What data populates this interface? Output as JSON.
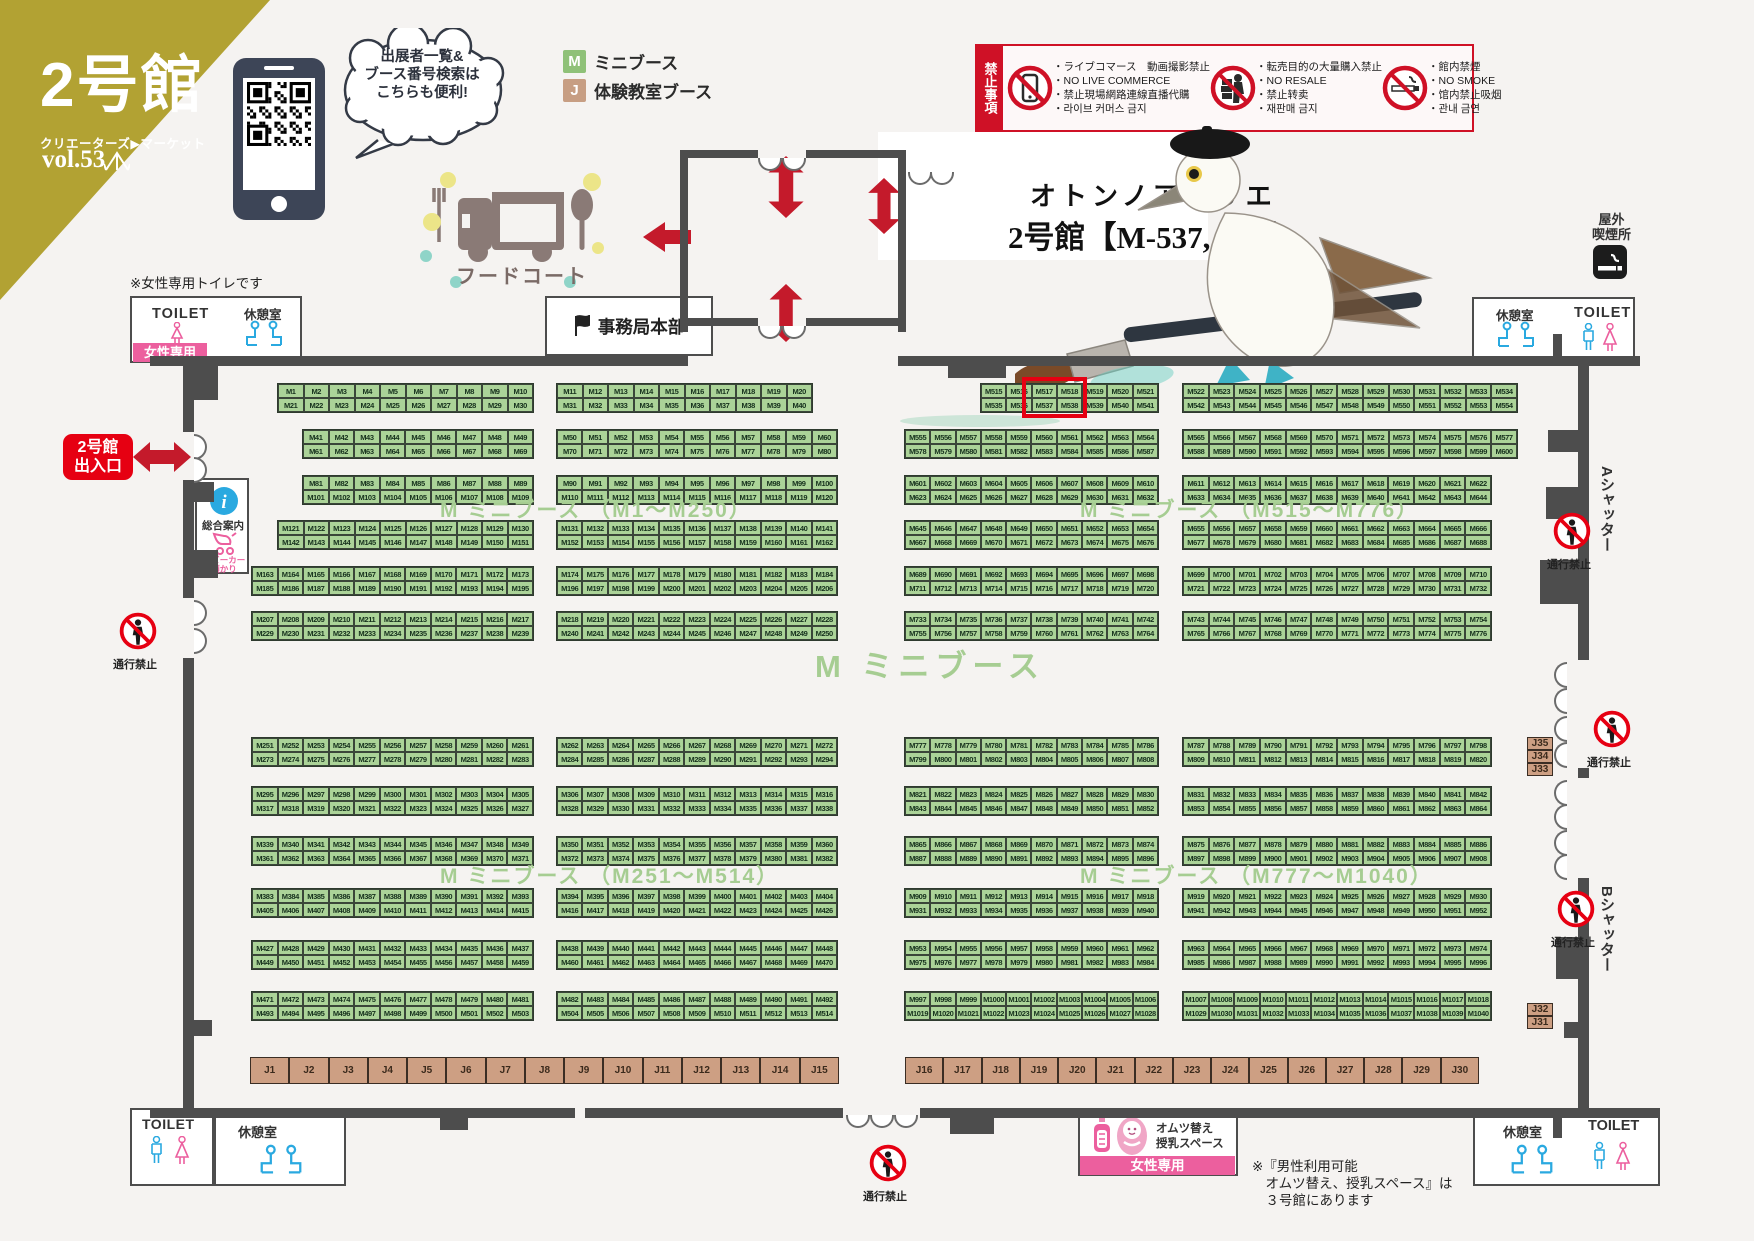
{
  "header": {
    "hall": "2号館",
    "brand": "クリエーターズ▶マーケット",
    "vol": "vol.53",
    "bubble": [
      "出展者一覧&",
      "ブース番号検索は",
      "こちらも便利!"
    ]
  },
  "legend": {
    "m": {
      "code": "M",
      "label": "ミニブース",
      "color": "#8fc178"
    },
    "j": {
      "code": "J",
      "label": "体験教室ブース",
      "color": "#c79e83"
    }
  },
  "prohibited": {
    "title": "禁止事項",
    "groups": [
      {
        "icon": "no-live-commerce-icon",
        "lines": [
          "・ライブコマース　動画撮影禁止",
          "・NO LIVE COMMERCE",
          "・禁止現場網路連線直播代購",
          "・라이브 커머스 금지"
        ]
      },
      {
        "icon": "no-resale-icon",
        "lines": [
          "・転売目的の大量購入禁止",
          "・NO RESALE",
          "・禁止转卖",
          "・재판매 금지"
        ]
      },
      {
        "icon": "no-smoking-icon",
        "lines": [
          "・館内禁煙",
          "・NO SMOKE",
          "・馆内禁止吸烟",
          "・관내 금연"
        ]
      }
    ]
  },
  "highlight": {
    "line1": "オトンノアトリエ",
    "line2": "2号館【M-537, 538】"
  },
  "facilities": {
    "food_court": "フードコート",
    "office": "事務局本部",
    "outdoor_smoking": [
      "屋外",
      "喫煙所"
    ],
    "toilet": "TOILET",
    "rest_room": "休憩室",
    "women_only": "女性専用",
    "women_toilet_note": "※女性専用トイレです",
    "entrance": [
      "2号館",
      "出入口"
    ],
    "info": "総合案内",
    "stroller": [
      "ベビーカー",
      "預かり"
    ],
    "no_entry": "通行禁止",
    "shutter_a": "Aシャッター",
    "shutter_b": "Bシャッター",
    "diaper": [
      "オムツ替え",
      "授乳スペース"
    ],
    "diaper_note": [
      "※『男性利用可能",
      "　オムツ替え、授乳スペース』は",
      "　３号館にあります"
    ]
  },
  "section_labels": [
    {
      "text": "M ミニブース （M1〜M250）",
      "x": 440,
      "y": 494,
      "size": 21
    },
    {
      "text": "M ミニブース （M515〜M776）",
      "x": 1080,
      "y": 494,
      "size": 21
    },
    {
      "text": "M ミニブース",
      "x": 815,
      "y": 641,
      "size": 31
    },
    {
      "text": "M ミニブース （M251〜M514）",
      "x": 440,
      "y": 860,
      "size": 21
    },
    {
      "text": "M ミニブース （M777〜M1040）",
      "x": 1080,
      "y": 860,
      "size": 21
    }
  ],
  "map": {
    "booth_prefix": "M",
    "bands": [
      {
        "y": 384,
        "strips": [
          {
            "x": 278,
            "w": 255,
            "c": 10,
            "t": 1,
            "b": 21
          },
          {
            "x": 557,
            "w": 255,
            "c": 10,
            "t": 11,
            "b": 31
          },
          {
            "x": 981,
            "w": 177,
            "c": 7,
            "t": 515,
            "b": 535
          },
          {
            "x": 1183,
            "w": 334,
            "c": 13,
            "t": 522,
            "b": 542
          }
        ]
      },
      {
        "y": 430,
        "strips": [
          {
            "x": 303,
            "w": 230,
            "c": 9,
            "t": 41,
            "b": 61
          },
          {
            "x": 557,
            "w": 280,
            "c": 11,
            "t": 50,
            "b": 70
          },
          {
            "x": 905,
            "w": 253,
            "c": 10,
            "t": 555,
            "b": 578
          },
          {
            "x": 1183,
            "w": 334,
            "c": 13,
            "t": 565,
            "b": 588
          }
        ]
      },
      {
        "y": 476,
        "strips": [
          {
            "x": 303,
            "w": 230,
            "c": 9,
            "t": 81,
            "b": 101
          },
          {
            "x": 557,
            "w": 280,
            "c": 11,
            "t": 90,
            "b": 110
          },
          {
            "x": 905,
            "w": 253,
            "c": 10,
            "t": 601,
            "b": 623
          },
          {
            "x": 1183,
            "w": 308,
            "c": 12,
            "t": 611,
            "b": 633
          }
        ]
      },
      {
        "y": 521,
        "strips": [
          {
            "x": 278,
            "w": 255,
            "c": 10,
            "t": 121,
            "b": 142
          },
          {
            "x": 557,
            "w": 280,
            "c": 11,
            "t": 131,
            "b": 152
          },
          {
            "x": 905,
            "w": 253,
            "c": 10,
            "t": 645,
            "b": 667
          },
          {
            "x": 1183,
            "w": 308,
            "c": 12,
            "t": 655,
            "b": 677
          }
        ]
      },
      {
        "y": 567,
        "strips": [
          {
            "x": 252,
            "w": 281,
            "c": 11,
            "t": 163,
            "b": 185
          },
          {
            "x": 557,
            "w": 280,
            "c": 11,
            "t": 174,
            "b": 196
          },
          {
            "x": 905,
            "w": 253,
            "c": 10,
            "t": 689,
            "b": 711
          },
          {
            "x": 1183,
            "w": 308,
            "c": 12,
            "t": 699,
            "b": 721
          }
        ]
      },
      {
        "y": 612,
        "strips": [
          {
            "x": 252,
            "w": 281,
            "c": 11,
            "t": 207,
            "b": 229
          },
          {
            "x": 557,
            "w": 280,
            "c": 11,
            "t": 218,
            "b": 240
          },
          {
            "x": 905,
            "w": 253,
            "c": 10,
            "t": 733,
            "b": 755
          },
          {
            "x": 1183,
            "w": 308,
            "c": 12,
            "t": 743,
            "b": 765
          }
        ]
      },
      {
        "y": 738,
        "strips": [
          {
            "x": 252,
            "w": 281,
            "c": 11,
            "t": 251,
            "b": 273
          },
          {
            "x": 557,
            "w": 280,
            "c": 11,
            "t": 262,
            "b": 284
          },
          {
            "x": 905,
            "w": 253,
            "c": 10,
            "t": 777,
            "b": 799
          },
          {
            "x": 1183,
            "w": 308,
            "c": 12,
            "t": 787,
            "b": 809
          }
        ]
      },
      {
        "y": 787,
        "strips": [
          {
            "x": 252,
            "w": 281,
            "c": 11,
            "t": 295,
            "b": 317
          },
          {
            "x": 557,
            "w": 280,
            "c": 11,
            "t": 306,
            "b": 328
          },
          {
            "x": 905,
            "w": 253,
            "c": 10,
            "t": 821,
            "b": 843
          },
          {
            "x": 1183,
            "w": 308,
            "c": 12,
            "t": 831,
            "b": 853
          }
        ]
      },
      {
        "y": 837,
        "strips": [
          {
            "x": 252,
            "w": 281,
            "c": 11,
            "t": 339,
            "b": 361
          },
          {
            "x": 557,
            "w": 280,
            "c": 11,
            "t": 350,
            "b": 372
          },
          {
            "x": 905,
            "w": 253,
            "c": 10,
            "t": 865,
            "b": 887
          },
          {
            "x": 1183,
            "w": 308,
            "c": 12,
            "t": 875,
            "b": 897
          }
        ]
      },
      {
        "y": 889,
        "strips": [
          {
            "x": 252,
            "w": 281,
            "c": 11,
            "t": 383,
            "b": 405
          },
          {
            "x": 557,
            "w": 280,
            "c": 11,
            "t": 394,
            "b": 416
          },
          {
            "x": 905,
            "w": 253,
            "c": 10,
            "t": 909,
            "b": 931
          },
          {
            "x": 1183,
            "w": 308,
            "c": 12,
            "t": 919,
            "b": 941
          }
        ]
      },
      {
        "y": 941,
        "strips": [
          {
            "x": 252,
            "w": 281,
            "c": 11,
            "t": 427,
            "b": 449
          },
          {
            "x": 557,
            "w": 280,
            "c": 11,
            "t": 438,
            "b": 460
          },
          {
            "x": 905,
            "w": 253,
            "c": 10,
            "t": 953,
            "b": 975
          },
          {
            "x": 1183,
            "w": 308,
            "c": 12,
            "t": 963,
            "b": 985
          }
        ]
      },
      {
        "y": 992,
        "strips": [
          {
            "x": 252,
            "w": 281,
            "c": 11,
            "t": 471,
            "b": 493
          },
          {
            "x": 557,
            "w": 280,
            "c": 11,
            "t": 482,
            "b": 504
          },
          {
            "x": 905,
            "w": 253,
            "c": 10,
            "t": 997,
            "b": 1019
          },
          {
            "x": 1183,
            "w": 308,
            "c": 12,
            "t": 1007,
            "b": 1029
          }
        ]
      }
    ],
    "j_rows": [
      {
        "x": 250,
        "y": 1057,
        "w": 589,
        "h": 27,
        "start": 1,
        "count": 15
      },
      {
        "x": 905,
        "y": 1057,
        "w": 574,
        "h": 27,
        "start": 16,
        "count": 15
      }
    ],
    "j_stacks": [
      {
        "x": 1527,
        "y": 737,
        "w": 26,
        "cell_h": 39,
        "labels": [
          "J35",
          "J34",
          "J33"
        ]
      },
      {
        "x": 1527,
        "y": 1003,
        "w": 26,
        "cell_h": 40,
        "labels": [
          "J32",
          "J31"
        ]
      }
    ],
    "highlight_box": {
      "x": 1022,
      "y": 377,
      "w": 65,
      "h": 41
    },
    "no_entry_positions": [
      {
        "x": 118,
        "y": 612
      },
      {
        "x": 1552,
        "y": 512
      },
      {
        "x": 1592,
        "y": 710
      },
      {
        "x": 1556,
        "y": 890
      },
      {
        "x": 868,
        "y": 1144
      }
    ],
    "walls": [
      [
        150,
        356,
        538,
        10
      ],
      [
        898,
        356,
        742,
        10
      ],
      [
        948,
        356,
        58,
        22
      ],
      [
        183,
        356,
        11,
        76
      ],
      [
        183,
        480,
        11,
        118
      ],
      [
        183,
        658,
        11,
        452
      ],
      [
        194,
        366,
        24,
        34
      ],
      [
        194,
        482,
        20,
        20
      ],
      [
        194,
        550,
        24,
        28
      ],
      [
        194,
        1020,
        18,
        16
      ],
      [
        1578,
        356,
        11,
        304
      ],
      [
        1578,
        768,
        11,
        10
      ],
      [
        1578,
        878,
        11,
        232
      ],
      [
        1548,
        430,
        30,
        22
      ],
      [
        1546,
        487,
        34,
        32
      ],
      [
        1540,
        560,
        40,
        44
      ],
      [
        1556,
        937,
        33,
        42
      ],
      [
        1564,
        1022,
        25,
        16
      ],
      [
        150,
        1108,
        425,
        10
      ],
      [
        585,
        1108,
        258,
        10
      ],
      [
        920,
        1108,
        740,
        10
      ],
      [
        950,
        1108,
        44,
        26
      ],
      [
        440,
        1108,
        28,
        22
      ],
      [
        680,
        150,
        8,
        182
      ],
      [
        898,
        150,
        8,
        182
      ],
      [
        688,
        150,
        70,
        8
      ],
      [
        806,
        150,
        92,
        8
      ],
      [
        688,
        318,
        70,
        8
      ],
      [
        806,
        318,
        92,
        8
      ],
      [
        1553,
        334,
        9,
        28
      ],
      [
        1553,
        1108,
        9,
        30
      ]
    ],
    "doors": [
      {
        "x": 194,
        "y": 434,
        "o": "r"
      },
      {
        "x": 194,
        "y": 457,
        "o": "r"
      },
      {
        "x": 194,
        "y": 600,
        "o": "r"
      },
      {
        "x": 194,
        "y": 628,
        "o": "r"
      },
      {
        "x": 1554,
        "y": 662,
        "o": "l"
      },
      {
        "x": 1554,
        "y": 688,
        "o": "l"
      },
      {
        "x": 1554,
        "y": 716,
        "o": "l"
      },
      {
        "x": 1554,
        "y": 742,
        "o": "l"
      },
      {
        "x": 1554,
        "y": 780,
        "o": "l"
      },
      {
        "x": 1554,
        "y": 804,
        "o": "l"
      },
      {
        "x": 1554,
        "y": 830,
        "o": "l"
      },
      {
        "x": 1554,
        "y": 854,
        "o": "l"
      },
      {
        "x": 846,
        "y": 1115,
        "o": "d"
      },
      {
        "x": 870,
        "y": 1115,
        "o": "d"
      },
      {
        "x": 894,
        "y": 1115,
        "o": "d"
      },
      {
        "x": 758,
        "y": 158,
        "o": "d"
      },
      {
        "x": 782,
        "y": 158,
        "o": "d"
      },
      {
        "x": 758,
        "y": 326,
        "o": "d"
      },
      {
        "x": 782,
        "y": 326,
        "o": "d"
      },
      {
        "x": 908,
        "y": 172,
        "o": "d"
      },
      {
        "x": 930,
        "y": 172,
        "o": "d"
      }
    ]
  }
}
